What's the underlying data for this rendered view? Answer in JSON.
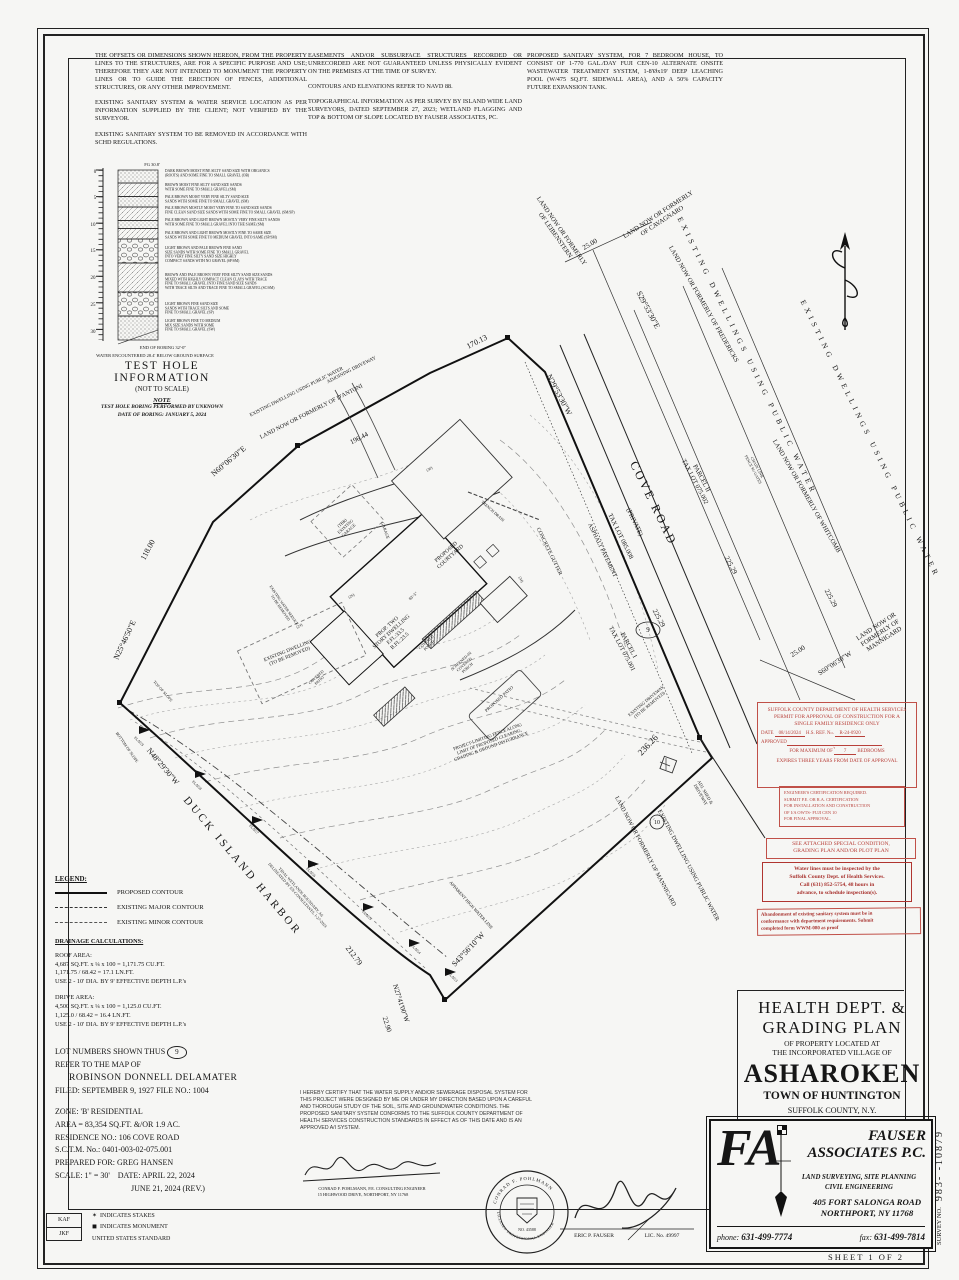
{
  "notes": {
    "c1p1": "THE OFFSETS OR DIMENSIONS SHOWN HEREON, FROM THE PROPERTY LINES TO THE STRUCTURES, ARE FOR A SPECIFIC PURPOSE AND USE; THEREFORE THEY ARE NOT INTENDED TO MONUMENT THE PROPERTY LINES OR TO GUIDE THE ERECTION OF FENCES, ADDITIONAL STRUCTURES, OR ANY OTHER IMPROVEMENT.",
    "c1p2": "EXISTING SANITARY SYSTEM & WATER SERVICE LOCATION AS PER INFORMATION SUPPLIED BY THE CLIENT; NOT VERIFIED BY THE SURVEYOR.",
    "c1p3": "EXISTING SANITARY SYSTEM TO BE REMOVED IN ACCORDANCE WITH SCHD REGULATIONS.",
    "c2p1": "EASEMENTS AND/OR SUBSURFACE STRUCTURES RECORDED OR UNRECORDED ARE NOT GUARANTEED UNLESS PHYSICALLY EVIDENT ON THE PREMISES AT THE TIME OF SURVEY.",
    "c2p2": "CONTOURS AND ELEVATIONS REFER TO NAVD 88.",
    "c2p3": "TOPOGRAPHICAL INFORMATION AS PER SURVEY BY ISLAND WIDE LAND SURVEYORS, DATED SEPTEMBER 27, 2023; WETLAND FLAGGING AND TOP & BOTTOM OF SLOPE LOCATED BY FAUSER ASSOCIATES, PC.",
    "c3p1": "PROPOSED SANITARY SYSTEM, FOR 7 BEDROOM HOUSE, TO CONSIST OF 1-770 GAL./DAY FUJI CEN-10 ALTERNATE ONSITE WASTEWATER TREATMENT SYSTEM, 1-8'Øx19' DEEP LEACHING POOL (W/475 SQ.FT. SIDEWALL AREA), AND A 50% CAPACITY FUTURE EXPANSION TANK."
  },
  "test_hole": {
    "title": "TEST HOLE INFORMATION",
    "subtitle": "(NOT TO SCALE)",
    "note_label": "NOTE",
    "note_lines": [
      "TEST HOLE BORING PERFORMED BY UNKNOWN",
      "DATE OF BORING: JANUARY 5, 2024"
    ],
    "layers": [
      {
        "h": 13,
        "p": "d",
        "ty": 172,
        "lines": [
          "DARK BROWN MOIST FINE SILTY SAND SIZE WITH ORGANICS",
          "(ROOTS) AND SOME FINE TO SMALL GRAVEL (OB)"
        ]
      },
      {
        "h": 13.5,
        "p": "g",
        "ty": 186,
        "lines": [
          "BROWN MOIST FINE SILTY SAND SIZE SANDS",
          "WITH SOME FINE TO SMALL GRAVEL (SM)"
        ]
      },
      {
        "h": 10.5,
        "p": "d",
        "ty": 198,
        "lines": [
          "PALE BROWN MOIST VERY FINE SILTY SAND SIZE",
          "SANDS WITH SOME FINE TO SMALL GRAVEL (SM)"
        ]
      },
      {
        "h": 13.5,
        "p": "g",
        "ty": 209,
        "lines": [
          "PALE BROWN MOSTLY MOIST VERY FINE TO SAND SIZE SANDS",
          "FINE CLEAN SAND SIZE SANDS WITH SOME FINE TO SMALL GRAVEL (SM/SP)"
        ]
      },
      {
        "h": 8,
        "p": "d",
        "ty": 221,
        "lines": [
          "PALE BROWN AND LIGHT BROWN MOSTLY VERY FINE SILTY SANDS",
          "WITH SOME FINE TO SMALL GRAVEL INTO THE SAME (SM)"
        ]
      },
      {
        "h": 10.5,
        "p": "g",
        "ty": 234,
        "lines": [
          "PALE BROWN AND LIGHT BROWN MOSTLY FINE TO SAME SIZE",
          "SANDS WITH SOME FINE TO MEDIUM GRAVEL INTO SAME (SP/SM)"
        ]
      },
      {
        "h": 24,
        "p": "s",
        "ty": 249,
        "lines": [
          "LIGHT BROWN AND PALE BROWN FINE SAND",
          "SIZE SANDS WITH SOME FINE TO SMALL GRAVEL",
          "INTO VERY FINE SILTY SAND SIZE HIGHLY",
          "COMPACT SANDS WITH NO GRAVEL (SP/SM)"
        ]
      },
      {
        "h": 29,
        "p": "g",
        "ty": 276,
        "lines": [
          "BROWN AND PALE BROWN VERY FINE SILTY SAND SIZE SANDS",
          "MIXED WITH HIGHLY COMPACT CLEAN CLAYS WITH TRACE",
          "FINE TO SMALL GRAVEL INTO FINE SAND SIZE SANDS",
          "WITH TRACE SILTS AND TRACE FINE TO SMALL GRAVEL (SC/SM)"
        ]
      },
      {
        "h": 24,
        "p": "s",
        "ty": 305,
        "lines": [
          "LIGHT BROWN FINE SAND SIZE",
          "SANDS WITH TRACE SILTS AND SOME",
          "FINE TO SMALL GRAVEL (SP)"
        ]
      },
      {
        "h": 24,
        "p": "d",
        "ty": 322,
        "lines": [
          "LIGHT BROWN FINE TO MEDIUM",
          "MIX SIZE SANDS WITH SOME",
          "FINE TO SMALL GRAVEL (SW)"
        ]
      }
    ]
  },
  "legend": {
    "header": "LEGEND:",
    "items": [
      "PROPOSED CONTOUR",
      "EXISTING MAJOR CONTOUR",
      "EXISTING MINOR CONTOUR"
    ]
  },
  "drainage": {
    "header": "DRAINAGE CALCULATIONS:",
    "roof": [
      "ROOF AREA:",
      "4,687 SQ.FT. x ¼ x 100 = 1,171.75 CU.FT.",
      "1,171.75 / 68.42 = 17.1 LN.FT.",
      "USE 2 - 10' DIA. BY 9' EFFECTIVE DEPTH L.P.'s"
    ],
    "drive": [
      "DRIVE AREA:",
      "4,500 SQ.FT. x ¼ x 100 = 1,125.0 CU.FT.",
      "1,125.0 / 68.42 = 16.4 LN.FT.",
      "USE 2 - 10' DIA. BY 9' EFFECTIVE DEPTH L.P.'s"
    ]
  },
  "lot": {
    "line1": "LOT NUMBERS SHOWN THUS",
    "num": "9",
    "line2": "REFER TO THE MAP OF",
    "map_name": "ROBINSON DONNELL DELAMATER",
    "line4": "FILED: SEPTEMBER 9, 1927    FILE NO.: 1004"
  },
  "zone": {
    "lines": [
      "ZONE: 'B' RESIDENTIAL",
      "AREA = 83,354 SQ.FT. &/OR 1.9 AC.",
      "RESIDENCE NO.: 106 COVE ROAD",
      "S.C.T.M. No.: 0401-003-02-075.001",
      "PREPARED FOR: GREG HANSEN",
      "SCALE: 1\" = 30'    DATE: APRIL 22, 2024",
      "                                      JUNE 21, 2024 (REV.)"
    ]
  },
  "stamps": {
    "permit": {
      "header": [
        "SUFFOLK COUNTY DEPARTMENT OF HEALTH SERVICES",
        "PERMIT FOR APPROVAL OF CONSTRUCTION FOR A",
        "SINGLE FAMILY RESIDENCE ONLY"
      ],
      "date_label": "DATE",
      "date": "08/14/2024",
      "ref_label": "H.S. REF. No.",
      "ref": "R-24-0920",
      "approved_label": "APPROVED",
      "max_label": "FOR MAXIMUM OF",
      "bedrooms": "7",
      "bedrooms_label": "BEDROOMS",
      "expires": "EXPIRES THREE YEARS FROM DATE OF APPROVAL"
    },
    "engineer_cert": [
      "ENGINEER'S CERTIFICATION REQUIRED.",
      "SUBMIT P.E. OR R.A. CERTIFICATION",
      "FOR INSTALLATION AND CONSTRUCTION",
      "OF  I/A OWTS- FUJI CEN 10",
      "FOR FINAL APPROVAL."
    ],
    "special_condition": [
      "SEE ATTACHED SPECIAL CONDITION,",
      "GRADING PLAN AND/OR PLOT PLAN"
    ],
    "water_lines": [
      "Water lines must be inspected by the",
      "Suffolk County Dept. of Health Services.",
      "Call (631) 852-5754, 48 hours in",
      "advance, to schedule inspection(s)."
    ],
    "abandonment": [
      "Abandonment of existing sanitary system must be in",
      "conformance with department requirements. Submit",
      "completed form WWM-080 as proof"
    ]
  },
  "certification": {
    "text": "I HEREBY CERTIFY THAT THE WATER SUPPLY AND/OR SEWERAGE DISPOSAL SYSTEM FOR THIS PROJECT WERE DESIGNED BY ME OR UNDER MY DIRECTION BASED UPON A CAREFUL AND THOROUGH STUDY OF THE SOIL, SITE AND GROUNDWATER CONDITIONS. THE PROPOSED SANITARY SYSTEM CONFORMS TO THE SUFFOLK COUNTY DEPARTMENT OF HEALTH SERVICES CONSTRUCTION STANDARDS IN EFFECT AS OF THIS DATE AND IS AN APPROVED A/I SYSTEM.",
    "seal_name": "CONRAD F. POHLMANN",
    "seal_title": "LICENSED PROFESSIONAL ENGINEER",
    "seal_no": "NO. 43588"
  },
  "title_block": {
    "l1a": "HEALTH DEPT. &",
    "l1b": "GRADING PLAN",
    "l2a": "OF PROPERTY LOCATED AT",
    "l2b": "THE INCORPORATED VILLAGE OF",
    "village": "ASHAROKEN",
    "town": "TOWN OF HUNTINGTON",
    "county": "SUFFOLK COUNTY, N.Y."
  },
  "firm": {
    "logo": "FA",
    "name1": "FAUSER",
    "name2": "ASSOCIATES P.C.",
    "svc1": "LAND SURVEYING, SITE PLANNING",
    "svc2": "CIVIL ENGINEERING",
    "addr1": "405 FORT SALONGA ROAD",
    "addr2": "NORTHPORT, NY 11768",
    "phone_label": "phone:",
    "phone": "631-499-7774",
    "fax_label": "fax:",
    "fax": "631-499-7814"
  },
  "edge": {
    "survey_label": "SURVEY NO.",
    "survey_num": "983-    -10879",
    "sheet": "SHEET 1 OF 2"
  },
  "corner": {
    "kaf": "KAF",
    "jkf": "JKF",
    "stakes": "INDICATES STAKES",
    "monument": "INDICATES MONUMENT",
    "standard": "UNITED STATES STANDARD"
  },
  "map": {
    "labels": [
      {
        "t": "0",
        "x": 95,
        "y": 173,
        "r": 0,
        "s": 5
      },
      {
        "t": "5",
        "x": 95,
        "y": 199,
        "r": 0,
        "s": 5
      },
      {
        "t": "10",
        "x": 93,
        "y": 226,
        "r": 0,
        "s": 5
      },
      {
        "t": "15",
        "x": 93,
        "y": 252,
        "r": 0,
        "s": 5
      },
      {
        "t": "20",
        "x": 93,
        "y": 279,
        "r": 0,
        "s": 5
      },
      {
        "t": "25",
        "x": 93,
        "y": 306,
        "r": 0,
        "s": 5
      },
      {
        "t": "30",
        "x": 93,
        "y": 333,
        "r": 0,
        "s": 5
      },
      {
        "t": "FG 30.8'",
        "x": 152,
        "y": 166,
        "r": 0,
        "s": 4.5
      },
      {
        "t": "END OF BORING 32'-0\"",
        "x": 163,
        "y": 349,
        "r": 0,
        "s": 4.5
      },
      {
        "t": "WATER ENCOUNTERED 28.4' BELOW GROUND SURFACE",
        "x": 155,
        "y": 357,
        "r": 0,
        "s": 4.5
      },
      {
        "t": "N60°06'30\"E",
        "x": 230,
        "y": 463,
        "r": -40,
        "s": 8
      },
      {
        "t": "196.44",
        "x": 360,
        "y": 440,
        "r": -27,
        "s": 7
      },
      {
        "t": "118.00",
        "x": 150,
        "y": 551,
        "r": -62,
        "s": 8
      },
      {
        "t": "N25°46'50\"E",
        "x": 127,
        "y": 641,
        "r": -65,
        "s": 8
      },
      {
        "t": "N48°29'30\"W",
        "x": 161,
        "y": 768,
        "r": 50,
        "s": 8
      },
      {
        "t": "DUCK ISLAND HARBOR",
        "x": 240,
        "y": 868,
        "r": 50,
        "s": 11,
        "ls": 3
      },
      {
        "t": "212.79",
        "x": 352,
        "y": 957,
        "r": 53,
        "s": 8
      },
      {
        "t": "N27°41'00\"W",
        "x": 399,
        "y": 1004,
        "r": 72,
        "s": 7
      },
      {
        "t": "22.90",
        "x": 385,
        "y": 1025,
        "r": 72,
        "s": 7
      },
      {
        "t": "S43°56'10\"W",
        "x": 470,
        "y": 951,
        "r": -47,
        "s": 8
      },
      {
        "t": "236.26",
        "x": 650,
        "y": 747,
        "r": -47,
        "s": 9
      },
      {
        "t": "25.00",
        "x": 799,
        "y": 653,
        "r": -33,
        "s": 7
      },
      {
        "t": "S60°06'30\"W",
        "x": 836,
        "y": 665,
        "r": -33,
        "s": 7
      },
      {
        "t": "25.00",
        "x": 591,
        "y": 246,
        "r": -30,
        "s": 7
      },
      {
        "t": "S29°53'30\"E",
        "x": 646,
        "y": 311,
        "r": 62,
        "s": 8
      },
      {
        "t": "N29°53'30\"W",
        "x": 557,
        "y": 396,
        "r": 62,
        "s": 8
      },
      {
        "t": "170.13",
        "x": 478,
        "y": 344,
        "r": -27,
        "s": 8
      },
      {
        "t": "225.29",
        "x": 729,
        "y": 566,
        "r": 62,
        "s": 7
      },
      {
        "t": "225.29",
        "x": 829,
        "y": 599,
        "r": 62,
        "s": 7
      },
      {
        "t": "225.29",
        "x": 657,
        "y": 619,
        "r": 62,
        "s": 7
      },
      {
        "t": "COVE ROAD",
        "x": 650,
        "y": 505,
        "r": 64,
        "s": 12,
        "ls": 2.5
      },
      {
        "t": "(PRIVATE)",
        "x": 633,
        "y": 523,
        "r": 64,
        "s": 6.5
      },
      {
        "t": "TAX LOT 085.008",
        "x": 619,
        "y": 537,
        "r": 64,
        "s": 6.5
      },
      {
        "t": "ASPHALT PAVEMENT",
        "x": 601,
        "y": 551,
        "r": 64,
        "s": 6
      },
      {
        "t": "CONCRETE GUTTER",
        "x": 548,
        "y": 552,
        "r": 64,
        "s": 5.5
      },
      {
        "t": "PARCEL II|TAX LOT 075.002",
        "x": 700,
        "y": 479,
        "r": 62,
        "s": 6.5
      },
      {
        "t": "PARCEL I|TAX LOT 075.001",
        "x": 627,
        "y": 646,
        "r": 62,
        "s": 6.5
      },
      {
        "t": "9",
        "x": 648,
        "y": 632,
        "r": 0,
        "s": 7
      },
      {
        "t": "10",
        "x": 657,
        "y": 824,
        "r": 0,
        "s": 6
      },
      {
        "t": "EXISTING DRIVEWAY|(TO BE REMOVED)",
        "x": 647,
        "y": 702,
        "r": -40,
        "s": 4.5
      },
      {
        "t": "ADJ. SHED &|DRIVEWAY",
        "x": 704,
        "y": 793,
        "r": 60,
        "s": 4.5
      },
      {
        "t": "CHAIN LINK|FENCE W/ GATES",
        "x": 756,
        "y": 468,
        "r": 62,
        "s": 4
      },
      {
        "t": "LAND NOW OR FORMERLY|OF LEIBENSTERN",
        "x": 560,
        "y": 232,
        "r": 55,
        "s": 6.5
      },
      {
        "t": "LAND NOW OR FORMERLY|OF CAVAGNARO",
        "x": 659,
        "y": 216,
        "r": -33,
        "s": 6.5
      },
      {
        "t": "LAND NOW OR FORMERLY OF FREDERICKS",
        "x": 702,
        "y": 305,
        "r": 60,
        "s": 6.5
      },
      {
        "t": "LAND NOW OR FORMERLY OF WHITCOMB",
        "x": 805,
        "y": 497,
        "r": 60,
        "s": 6.5
      },
      {
        "t": "LAND NOW OR|FORMERLY OF|MANNIGARD",
        "x": 877,
        "y": 628,
        "r": -33,
        "s": 6.5
      },
      {
        "t": "LAND NOW OR FORMERLY OF MANNIGARD",
        "x": 644,
        "y": 852,
        "r": 62,
        "s": 6
      },
      {
        "t": "EXISTING DWELLING USING PUBLIC WATER",
        "x": 687,
        "y": 866,
        "r": 62,
        "s": 6
      },
      {
        "t": "EXISTING DWELLINGS USING PUBLIC WATER",
        "x": 745,
        "y": 357,
        "r": 64,
        "s": 7.5,
        "ls": 4
      },
      {
        "t": "EXISTING DWELLINGS USING PUBLIC WATER",
        "x": 868,
        "y": 440,
        "r": 64,
        "s": 7.5,
        "ls": 4
      },
      {
        "t": "ADJOINING DRIVEWAY",
        "x": 352,
        "y": 371,
        "r": -27,
        "s": 5
      },
      {
        "t": "EXISTING DWELLING USING PUBLIC WATER",
        "x": 297,
        "y": 393,
        "r": -27,
        "s": 5
      },
      {
        "t": "LAND NOW OR FORMERLY OF D'ANTONI",
        "x": 312,
        "y": 413,
        "r": -27,
        "s": 6
      },
      {
        "t": "BOTTOM OF SLOPE",
        "x": 126,
        "y": 748,
        "r": 55,
        "s": 4
      },
      {
        "t": "TOP OF SLOPE",
        "x": 162,
        "y": 692,
        "r": 48,
        "s": 4
      },
      {
        "t": "TIDAL WETLANDS BOUNDARY, AS|DELINEATED BY EN-CONSULTANTS, 1-27-2024",
        "x": 300,
        "y": 893,
        "r": 48,
        "s": 4
      },
      {
        "t": "APPARENT HIGH WATER LINE",
        "x": 470,
        "y": 906,
        "r": 48,
        "s": 4.5
      },
      {
        "t": "PROJECT-LIMITING FENCE ALONG|LIMIT OF PROPOSED CLEARING,|GRADING & GROUND DISTURBANCE",
        "x": 488,
        "y": 738,
        "r": -20,
        "s": 4.5
      },
      {
        "t": "FLAG9",
        "x": 138,
        "y": 742,
        "r": 45,
        "s": 3.8
      },
      {
        "t": "FLAG8",
        "x": 196,
        "y": 786,
        "r": 45,
        "s": 3.8
      },
      {
        "t": "FLAG7",
        "x": 253,
        "y": 830,
        "r": 45,
        "s": 3.8
      },
      {
        "t": "FLAG6",
        "x": 310,
        "y": 873,
        "r": 45,
        "s": 3.8
      },
      {
        "t": "FLAG5",
        "x": 366,
        "y": 916,
        "r": 45,
        "s": 3.8
      },
      {
        "t": "FLAG4",
        "x": 415,
        "y": 950,
        "r": 45,
        "s": 3.8
      },
      {
        "t": "FLAG3",
        "x": 452,
        "y": 978,
        "r": 45,
        "s": 3.8
      },
      {
        "t": "PROP. TWO|STORY DWELLING|F.FL:33.5|B.FL:23.5",
        "x": 388,
        "y": 628,
        "r": -42,
        "s": 5.5
      },
      {
        "t": "PROPOSED|COURTYARD",
        "x": 447,
        "y": 553,
        "r": -42,
        "s": 5.5
      },
      {
        "t": "(TBR)|EXISTING|GARAGE",
        "x": 343,
        "y": 524,
        "r": -42,
        "s": 4.2
      },
      {
        "t": "GARAGE",
        "x": 384,
        "y": 531,
        "r": 70,
        "s": 4.2
      },
      {
        "t": "83'-5\"",
        "x": 414,
        "y": 597,
        "r": -42,
        "s": 4.2
      },
      {
        "t": "COVERED|PATIO",
        "x": 317,
        "y": 678,
        "r": -42,
        "s": 4
      },
      {
        "t": "COVERED|PORCH",
        "x": 427,
        "y": 643,
        "r": -42,
        "s": 4
      },
      {
        "t": "SCREENED-IN|COVERED|PORCH",
        "x": 462,
        "y": 662,
        "r": -42,
        "s": 4
      },
      {
        "t": "TRENCH DRAIN",
        "x": 492,
        "y": 512,
        "r": 42,
        "s": 4
      },
      {
        "t": "PROPOSED PATIO",
        "x": 500,
        "y": 700,
        "r": -42,
        "s": 4.5
      },
      {
        "t": "EXISTING DWELLING|(TO BE REMOVED)",
        "x": 288,
        "y": 652,
        "r": -22,
        "s": 5
      },
      {
        "t": "EXISTING WATER SERVICE|TO BE REMOVED",
        "x": 283,
        "y": 606,
        "r": 55,
        "s": 3.8
      },
      {
        "t": "(26)",
        "x": 352,
        "y": 597,
        "r": -30,
        "s": 3.8
      },
      {
        "t": "(24)",
        "x": 300,
        "y": 627,
        "r": -30,
        "s": 3.8
      },
      {
        "t": "(34)",
        "x": 520,
        "y": 580,
        "r": 62,
        "s": 3.8
      },
      {
        "t": "(30)",
        "x": 430,
        "y": 470,
        "r": -30,
        "s": 3.8
      },
      {
        "t": "ERIC P. FAUSER",
        "x": 594,
        "y": 1237,
        "r": 0,
        "s": 5.5
      },
      {
        "t": "LIC. No. 49997",
        "x": 662,
        "y": 1237,
        "r": 0,
        "s": 5.5
      },
      {
        "t": "CONRAD F. POHLMANN, P.E. CONSULTING ENGINEER",
        "x": 372,
        "y": 1190,
        "r": 0,
        "s": 4.3
      },
      {
        "t": "15 HIGHWOOD DRIVE, NORTHPORT, NY 11768",
        "x": 363,
        "y": 1196,
        "r": 0,
        "s": 4.3
      }
    ]
  }
}
